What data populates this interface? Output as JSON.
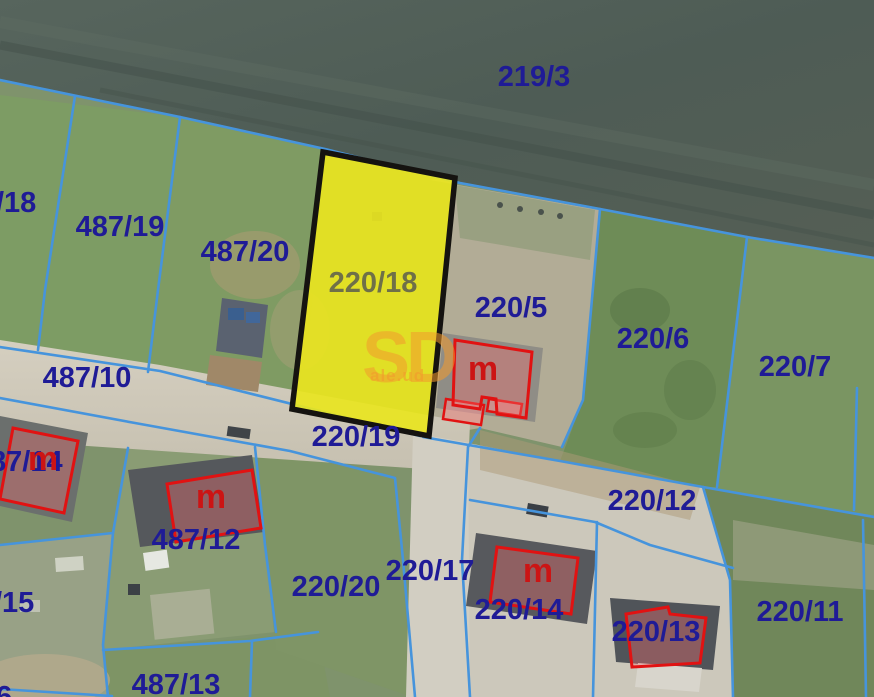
{
  "map": {
    "type": "cadastral-parcel-map-over-aerial-photo",
    "highlighted_parcel": "220/18",
    "marker_label": "m",
    "watermark": {
      "big": "SD",
      "small": "ale.ud"
    },
    "labels": {
      "p219_3": "219/3",
      "p487_18": "/18",
      "p487_19": "487/19",
      "p487_20": "487/20",
      "p220_18": "220/18",
      "p220_5": "220/5",
      "p220_6": "220/6",
      "p220_7": "220/7",
      "p487_10": "487/10",
      "p487_14": "87/14",
      "p220_19": "220/19",
      "p487_12": "487/12",
      "p220_12": "220/12",
      "p487_15": "/15",
      "p220_20": "220/20",
      "p220_17": "220/17",
      "p220_14": "220/14",
      "p220_13": "220/13",
      "p220_11": "220/11",
      "p487_13": "487/13",
      "p_partial_6": "6"
    },
    "colors": {
      "parcel_line": "#4694dc",
      "parcel_label": "#1f1b96",
      "highlight_fill": "#e9e520",
      "highlight_border": "#151310",
      "highlight_label": "#6f7048",
      "building_outline": "#e11212",
      "building_label": "#cc1414",
      "watermark": "#f39b2d"
    }
  }
}
